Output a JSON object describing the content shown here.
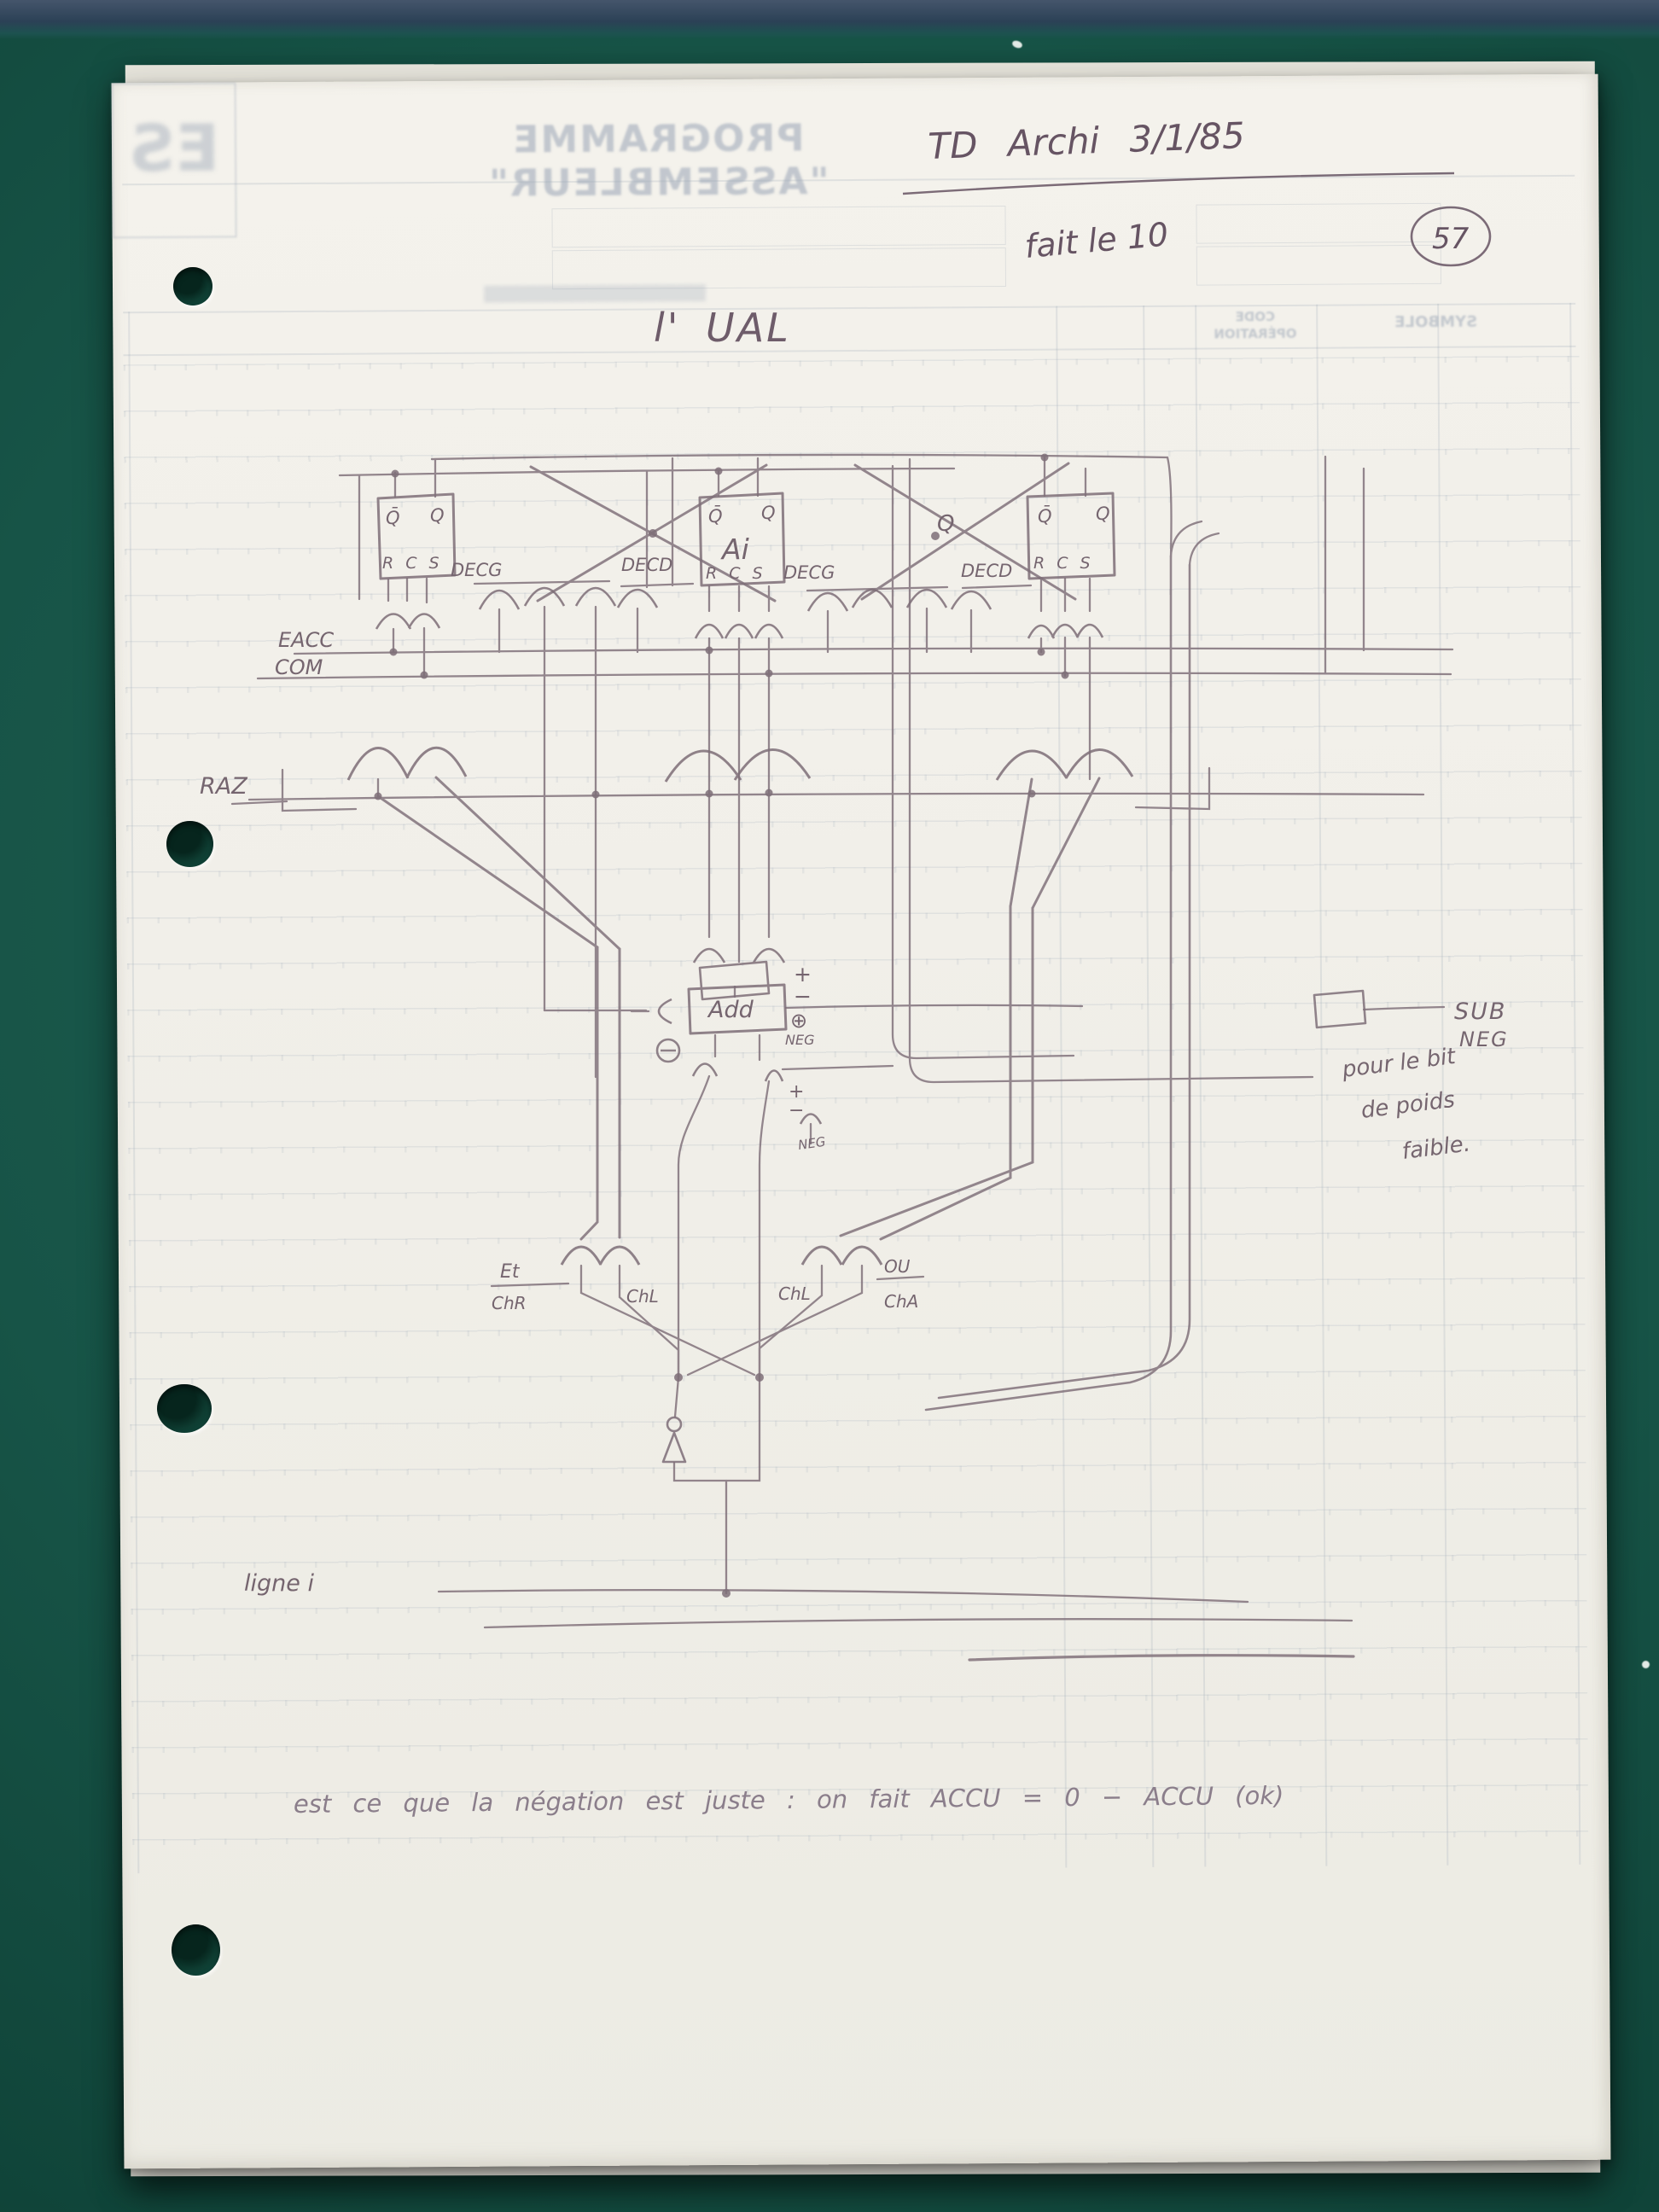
{
  "photo": {
    "surface_color": "#17544a",
    "top_band_color": "#2b4156",
    "pencil_color": "#7e6e78",
    "ink_color": "#665463"
  },
  "annotations": {
    "course_note": "TD Archi 3/1/85",
    "done_note": "fait le 10",
    "page_number": "57",
    "title": "l' UAL",
    "line_label": "ligne i",
    "bottom_question": "est ce que la négation est juste :  on fait   ACCU = 0 − ACCU   (ok)",
    "legend_sub": "SUB",
    "legend_neg": "NEG",
    "legend_note_1": "pour le bit",
    "legend_note_2": "de poids",
    "legend_note_3": "faible."
  },
  "schematic": {
    "bus_eacc": "EACC",
    "bus_com": "COM",
    "bus_raz": "RAZ",
    "sig_q": "Q",
    "decg": "DECG",
    "decd": "DECD",
    "ff_qbar": "Q̄",
    "ff_q": "Q",
    "ff_name": "Ai",
    "ff_rcs": "R C S",
    "adder": "Add",
    "plus": "+",
    "minus": "−",
    "xor": "⊕",
    "neg": "NEG",
    "plus2": "+",
    "minus2": "−",
    "neg2": "NEG",
    "op_et": "Et",
    "op_chr": "ChR",
    "op_chl": "ChL",
    "op_chl2": "ChL",
    "op_ou": "OU",
    "op_cha": "ChA"
  },
  "showthrough": {
    "form_title": "PROGRAMME \"ASSEMBLEUR\"",
    "logo": "ES",
    "col_code_1": "CODE",
    "col_code_2": "OPÉRATION",
    "col_symbole": "SYMBOLE"
  }
}
